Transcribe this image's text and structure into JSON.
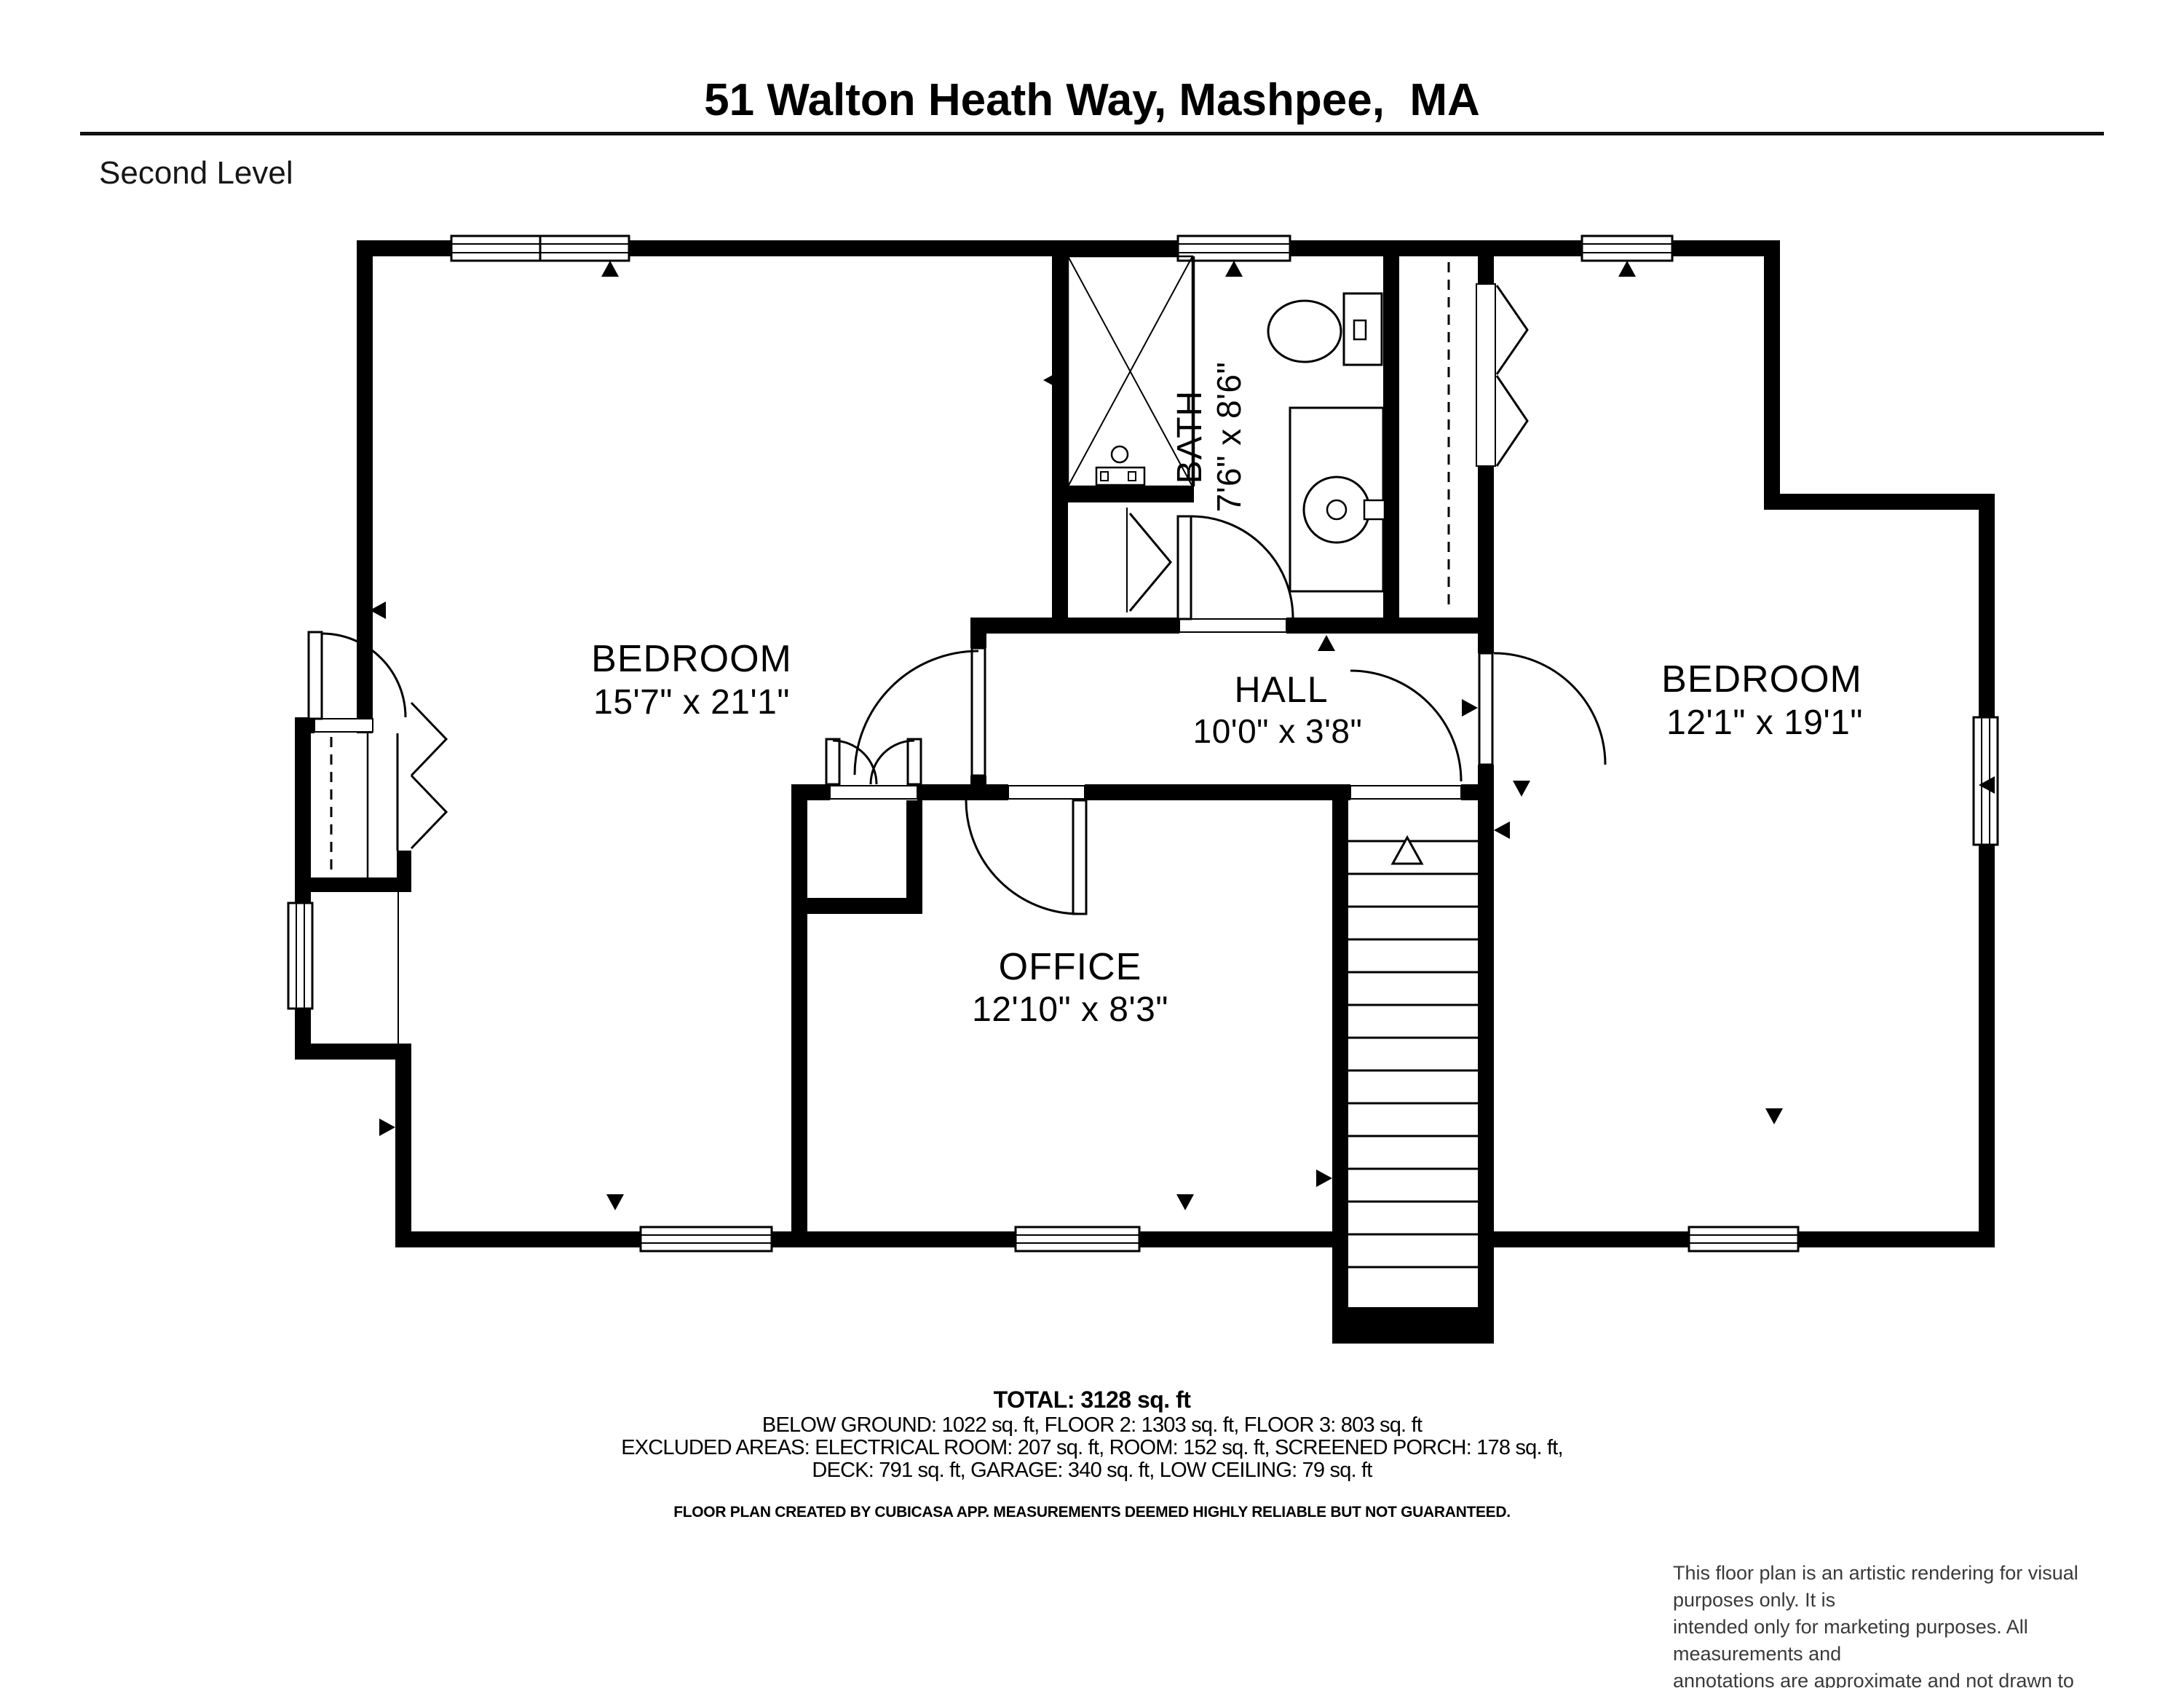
{
  "header": {
    "title": "51 Walton Heath Way, Mashpee,  MA",
    "level": "Second Level"
  },
  "rooms": [
    {
      "name": "BEDROOM",
      "dims": "15'7\" x 21'1\""
    },
    {
      "name": "BATH",
      "dims": "7'6\" x 8'6\""
    },
    {
      "name": "HALL",
      "dims": "10'0\" x 3'8\""
    },
    {
      "name": "BEDROOM",
      "dims": "12'1\" x 19'1\""
    },
    {
      "name": "OFFICE",
      "dims": "12'10\" x 8'3\""
    }
  ],
  "summary": {
    "total": "TOTAL: 3128 sq. ft",
    "line1": "BELOW GROUND: 1022 sq. ft, FLOOR 2: 1303 sq. ft, FLOOR 3: 803 sq. ft",
    "line2": "EXCLUDED AREAS: ELECTRICAL ROOM: 207 sq. ft, ROOM: 152 sq. ft, SCREENED PORCH: 178 sq. ft,",
    "line3": "DECK: 791 sq. ft, GARAGE: 340 sq. ft, LOW CEILING: 79 sq. ft",
    "credit": "FLOOR PLAN CREATED BY CUBICASA APP. MEASUREMENTS DEEMED HIGHLY RELIABLE BUT NOT GUARANTEED."
  },
  "disclaimer": {
    "lines": [
      "This floor plan is an artistic rendering for visual purposes only. It is",
      "intended only for marketing purposes. All measurements and",
      "annotations are approximate and not drawn to exact scale. Subject",
      "to errors and / or omissions."
    ]
  },
  "colors": {
    "wall": "#000000",
    "background": "#ffffff",
    "disclaimer_text": "#3a3a3a"
  }
}
